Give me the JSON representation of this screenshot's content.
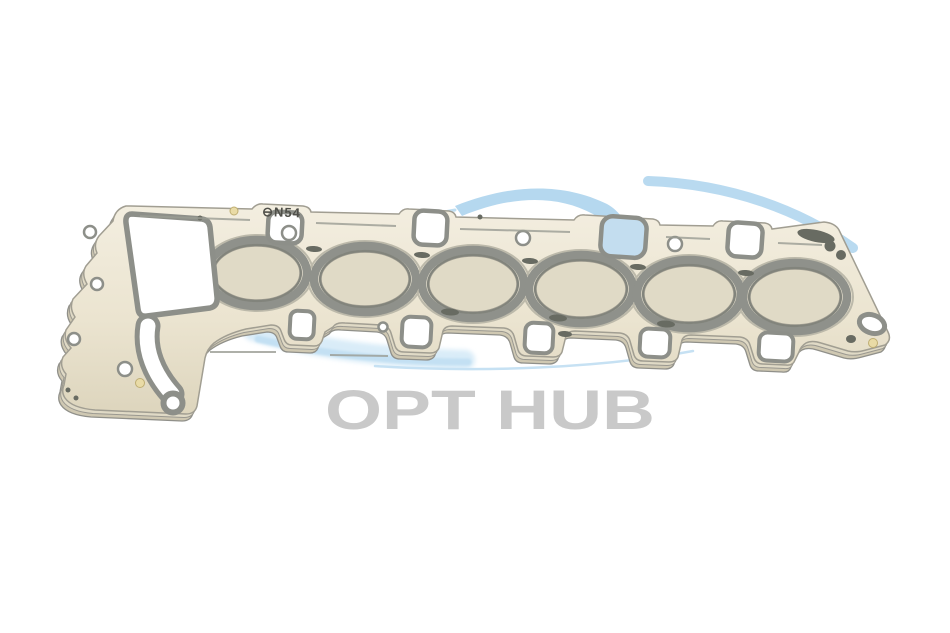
{
  "image": {
    "description": "Product photo of a six-cylinder multi-layer steel head gasket on a white background",
    "background_color": "#ffffff"
  },
  "watermark": {
    "brand": "OPT HUB",
    "text_color": "#c9c9c9",
    "swoosh_color": "#b5d8ef",
    "swoosh_soft_color": "#d9ecf8",
    "car_color": "#b4b4b2"
  },
  "part": {
    "stamp": "⊖N54",
    "stamp_color": "#4f4f49",
    "body_color": "#ece6d3",
    "bead_color": "#8f918b",
    "bore_count": "6"
  }
}
